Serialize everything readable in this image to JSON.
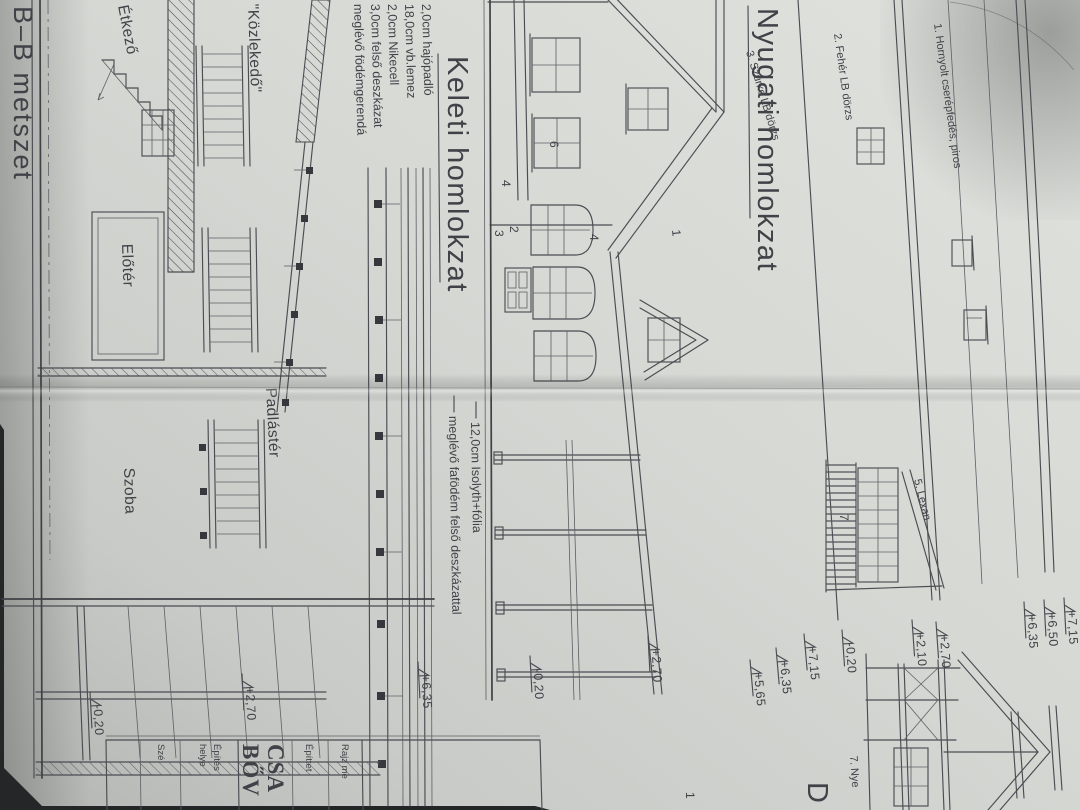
{
  "labels": {
    "bb_section": "B–B metszet",
    "east_title": "Keleti  homlokzat",
    "west_title": "Nyugati  homlokzat",
    "etkezo": "Étkező",
    "kozlekedo": "\"Közlekedő\"",
    "eloter": "Előtér",
    "padlaster": "Padlástér",
    "szoba": "Szoba",
    "letter_d": "D"
  },
  "layer_notes": [
    "2,0cm hajópadló",
    "18,0cm vb.lemez",
    "2,0cm Nikecell",
    "3,0cm felső deszkázat",
    "meglévő födémgerendá"
  ],
  "iso_note": [
    "12,0cm Isolyth+fólia",
    "meglévő fafödém felső deszkázattal"
  ],
  "west_notes": [
    "1. Hornyolt cserépfedés, piros",
    "2. Fehér LB dörzs",
    "3. Szürke LB dörzs",
    "5. Lexan",
    "7. Nye"
  ],
  "ref_numbers": {
    "n1": "1",
    "n2": "2",
    "n3": "3",
    "n4": "4",
    "n4b": "4",
    "n6": "6",
    "n7": "7",
    "n1b": "1"
  },
  "elevations": {
    "e1": "+7,15",
    "e2": "+6,50",
    "e3": "+6,35",
    "e4": "+2,70",
    "e5": "+2,10",
    "e6": "-0,20",
    "e7": "+7,15",
    "e8": "+6,35",
    "e9": "+5,65",
    "e10": "+2,70",
    "e11": "-0,20",
    "e12": "+6,35",
    "e13": "+2,70",
    "e14": "-0,20"
  },
  "title_block": {
    "row_drawing": "Rajz me",
    "row_client": "Építtet",
    "big_line1": "CSA",
    "big_line2": "BŐV",
    "row_site1": "Építés",
    "row_site2": "helye",
    "row_bottom": "Szé"
  },
  "colors": {
    "paper": "#d6d8d4",
    "ink": "#43464b",
    "backdrop": "#232527"
  }
}
